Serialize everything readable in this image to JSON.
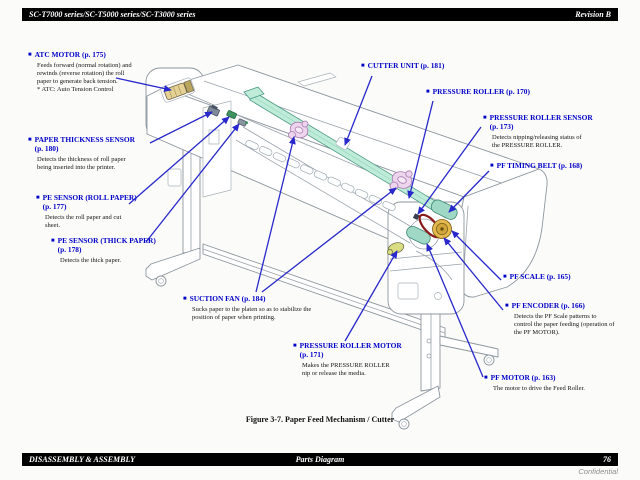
{
  "page": {
    "header": {
      "left": "SC-T7000 series/SC-T5000 series/SC-T3000 series",
      "right": "Revision B"
    },
    "footer": {
      "left": "DISASSEMBLY & ASSEMBLY",
      "center": "Parts Diagram",
      "page_number": "76"
    },
    "confidential": "Confidential",
    "figure_caption": "Figure 3-7. Paper Feed Mechanism / Cutter"
  },
  "colors": {
    "accent_blue": "#0000c8",
    "arrow_blue": "#2828cc",
    "rail_teal": "#bfecd9",
    "roller_teal": "#9fd8c4",
    "fan_pink": "#eed5ee",
    "motor_yellow": "#e5d193",
    "scale_ochre": "#e2b84f",
    "belt_dark_red": "#8b1a1a",
    "bar_black": "#000000"
  },
  "icons": {
    "callout_bullet": "■"
  },
  "callouts": [
    {
      "name": "atc-motor",
      "title": "ATC MOTOR (p. 175)",
      "body": "Feeds forward (normal rotation) and\nrewinds (reverse rotation) the roll\npaper to generate back tension.\n* ATC: Auto Tension Control"
    },
    {
      "name": "paper-thickness-sensor",
      "title": "PAPER THICKNESS SENSOR\n(p. 180)",
      "body": "Detects the thickness of roll paper\nbeing inserted into the printer."
    },
    {
      "name": "pe-sensor-roll-paper",
      "title": "PE SENSOR (ROLL PAPER)\n(p. 177)",
      "body": "Detects the roll paper and cut\nsheet."
    },
    {
      "name": "pe-sensor-thick-paper",
      "title": "PE SENSOR (THICK PAPER)\n(p. 178)",
      "body": "Detects the thick paper."
    },
    {
      "name": "cutter-unit",
      "title": "CUTTER UNIT (p. 181)",
      "body": ""
    },
    {
      "name": "pressure-roller",
      "title": "PRESSURE ROLLER (p. 170)",
      "body": ""
    },
    {
      "name": "pressure-roller-sensor",
      "title": "PRESSURE ROLLER SENSOR\n(p. 173)",
      "body": "Detects nipping/releasing status of\nthe PRESSURE ROLLER."
    },
    {
      "name": "pf-timing-belt",
      "title": "PF TIMING BELT (p. 168)",
      "body": ""
    },
    {
      "name": "pf-scale",
      "title": "PF SCALE (p. 165)",
      "body": ""
    },
    {
      "name": "pf-encoder",
      "title": "PF ENCODER (p. 166)",
      "body": "Detects the PF Scale patterns to\ncontrol the paper feeding (operation of\nthe PF MOTOR)."
    },
    {
      "name": "pf-motor",
      "title": "PF MOTOR (p. 163)",
      "body": "The motor to drive the Feed Roller."
    },
    {
      "name": "suction-fan",
      "title": "SUCTION FAN (p. 184)",
      "body": "Sucks paper to the platen so as to stabilize the\nposition of paper when printing."
    },
    {
      "name": "pressure-roller-motor",
      "title": "PRESSURE ROLLER MOTOR\n(p. 171)",
      "body": "Makes the PRESSURE ROLLER\nnip or release the media."
    }
  ]
}
